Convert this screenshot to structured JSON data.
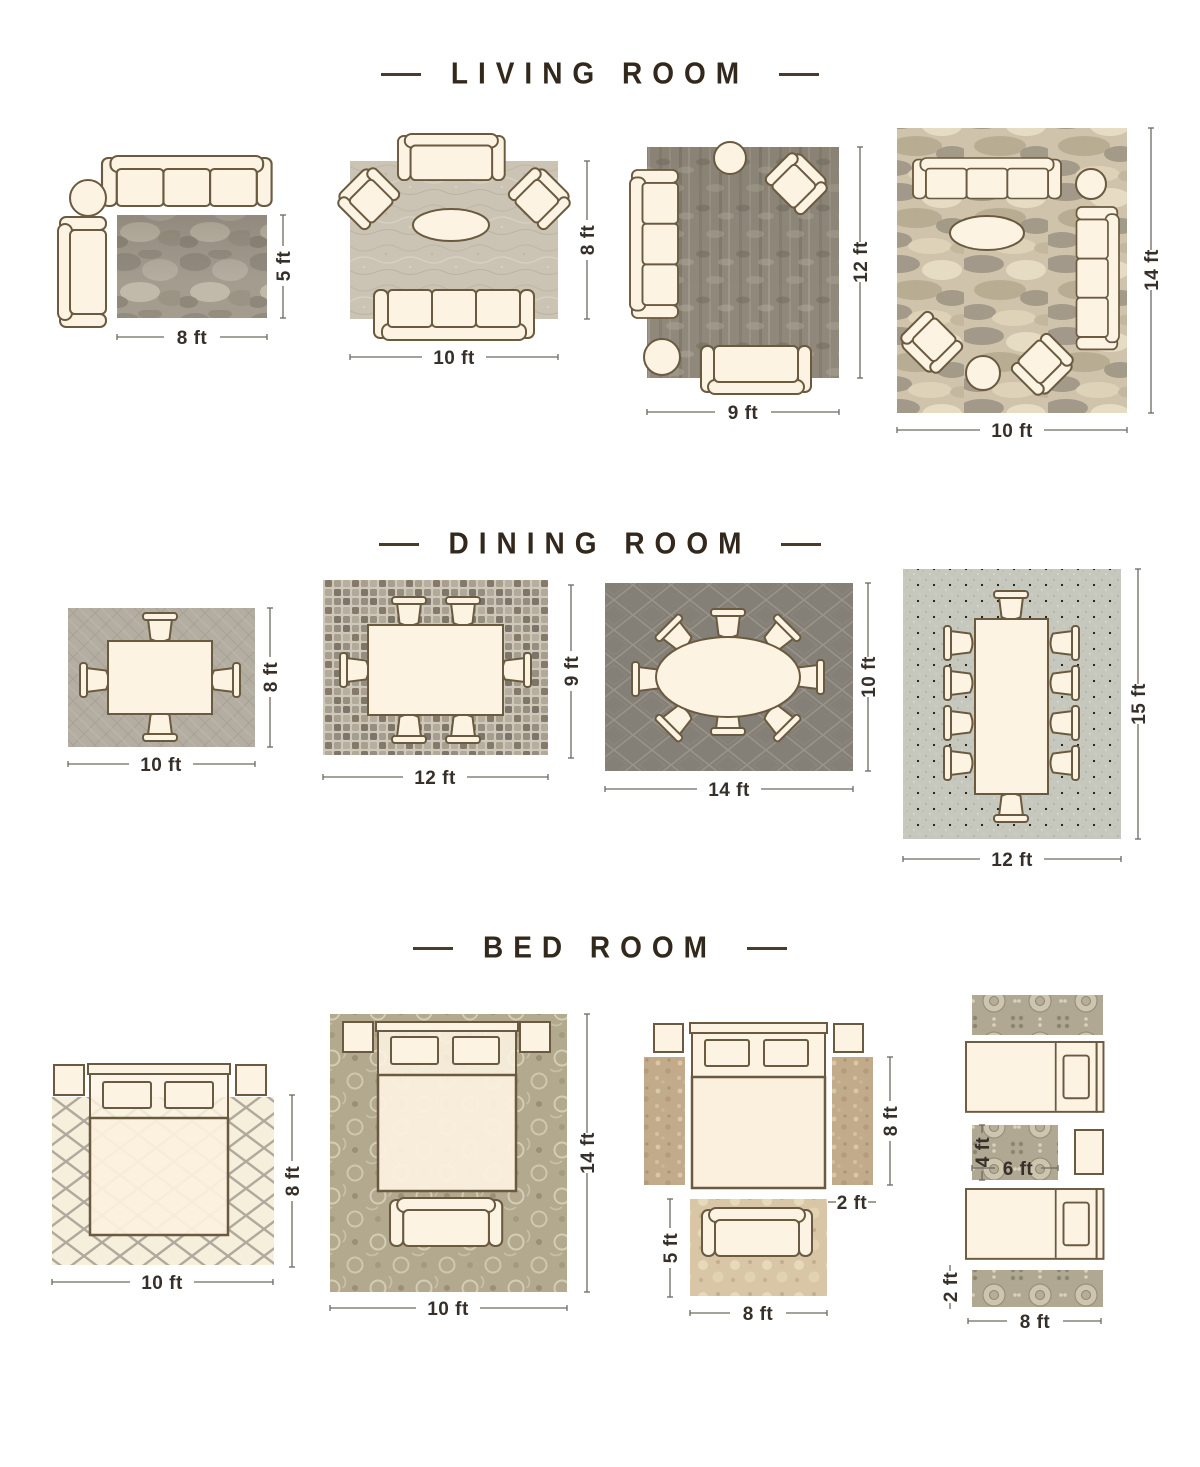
{
  "document_title": "Rug size placement guide",
  "colors": {
    "background": "#ffffff",
    "heading_text": "#33281c",
    "heading_dash": "#4a3b2b",
    "dimension_text": "#37302a",
    "dimension_line": "#6e6a62",
    "furniture_fill": "#fdf3e3",
    "furniture_stroke": "#6a5a40",
    "rug_gray_mottled": "#a49c8f",
    "rug_light_warm": "#cbc3b4",
    "rug_dark_olive": "#90897b",
    "rug_abstract_beige": "#cfc3ab",
    "rug_gray_cross": "#b4aea2",
    "rug_mosaic": "#cfc7b8",
    "rug_dark_trellis": "#847f77",
    "rug_linen": "#c7c8bd",
    "rug_cream_lattice": "#f6efdc",
    "rug_damask_olive": "#b2a98e",
    "rug_persian_tan": "#c2ab8a",
    "rug_floral_tan": "#d9c6a7",
    "rug_ornate_gray": "#b1a893"
  },
  "sections": [
    {
      "id": "living-room",
      "title": "LIVING ROOM",
      "layouts": [
        {
          "name": "living-rug-8x5",
          "width_label": "8 ft",
          "height_label": "5 ft",
          "furniture": [
            "sofa",
            "round-side-table",
            "loveseat"
          ],
          "rug": "gray mottled area rug"
        },
        {
          "name": "living-rug-10x8",
          "width_label": "10 ft",
          "height_label": "8 ft",
          "furniture": [
            "loveseat",
            "armchair",
            "armchair",
            "oval-coffee-table",
            "sofa"
          ],
          "rug": "light textured area rug"
        },
        {
          "name": "living-rug-9x12",
          "width_label": "9 ft",
          "height_label": "12 ft",
          "furniture": [
            "sofa",
            "round-side-table",
            "armchair",
            "round-side-table",
            "loveseat"
          ],
          "rug": "dark distressed area rug"
        },
        {
          "name": "living-rug-10x14",
          "width_label": "10 ft",
          "height_label": "14 ft",
          "furniture": [
            "sofa",
            "round-side-table",
            "sofa",
            "oval-coffee-table",
            "armchair",
            "armchair",
            "round-side-table"
          ],
          "rug": "abstract beige-gray area rug"
        }
      ]
    },
    {
      "id": "dining-room",
      "title": "DINING ROOM",
      "layouts": [
        {
          "name": "dining-rug-10x8",
          "width_label": "10 ft",
          "height_label": "8 ft",
          "furniture": [
            "dining-table",
            "4-chairs"
          ],
          "rug": "gray crosshatch area rug"
        },
        {
          "name": "dining-rug-12x9",
          "width_label": "12 ft",
          "height_label": "9 ft",
          "furniture": [
            "dining-table",
            "6-chairs"
          ],
          "rug": "mosaic area rug"
        },
        {
          "name": "dining-rug-14x10",
          "width_label": "14 ft",
          "height_label": "10 ft",
          "furniture": [
            "oval-dining-table",
            "8-chairs"
          ],
          "rug": "dark trellis area rug"
        },
        {
          "name": "dining-rug-12x15",
          "width_label": "12 ft",
          "height_label": "15 ft",
          "furniture": [
            "dining-table",
            "10-chairs"
          ],
          "rug": "light linen area rug"
        }
      ]
    },
    {
      "id": "bed-room",
      "title": "BED ROOM",
      "layouts": [
        {
          "name": "bed-rug-10x8",
          "width_label": "10 ft",
          "height_label": "8 ft",
          "furniture": [
            "nightstand",
            "bed",
            "nightstand"
          ],
          "rug": "cream lattice area rug"
        },
        {
          "name": "bed-rug-10x14",
          "width_label": "10 ft",
          "height_label": "14 ft",
          "furniture": [
            "nightstand",
            "bed",
            "nightstand",
            "bench"
          ],
          "rug": "damask area rug"
        },
        {
          "name": "bed-runners-and-accent",
          "width_label": "8 ft",
          "height_label": "8 ft",
          "runner_label": "2 ft",
          "accent_height_label": "5 ft",
          "furniture": [
            "nightstand",
            "bed",
            "nightstand",
            "loveseat"
          ],
          "rug": "two side runners and accent rug"
        },
        {
          "name": "bed-twin-runners",
          "width_label": "8 ft",
          "runner_label": "2 ft",
          "accent_width_label": "6 ft",
          "accent_height_label": "4 ft",
          "furniture": [
            "twin-bed",
            "nightstand",
            "twin-bed"
          ],
          "rug": "ornate runners and accent rug"
        }
      ]
    }
  ]
}
